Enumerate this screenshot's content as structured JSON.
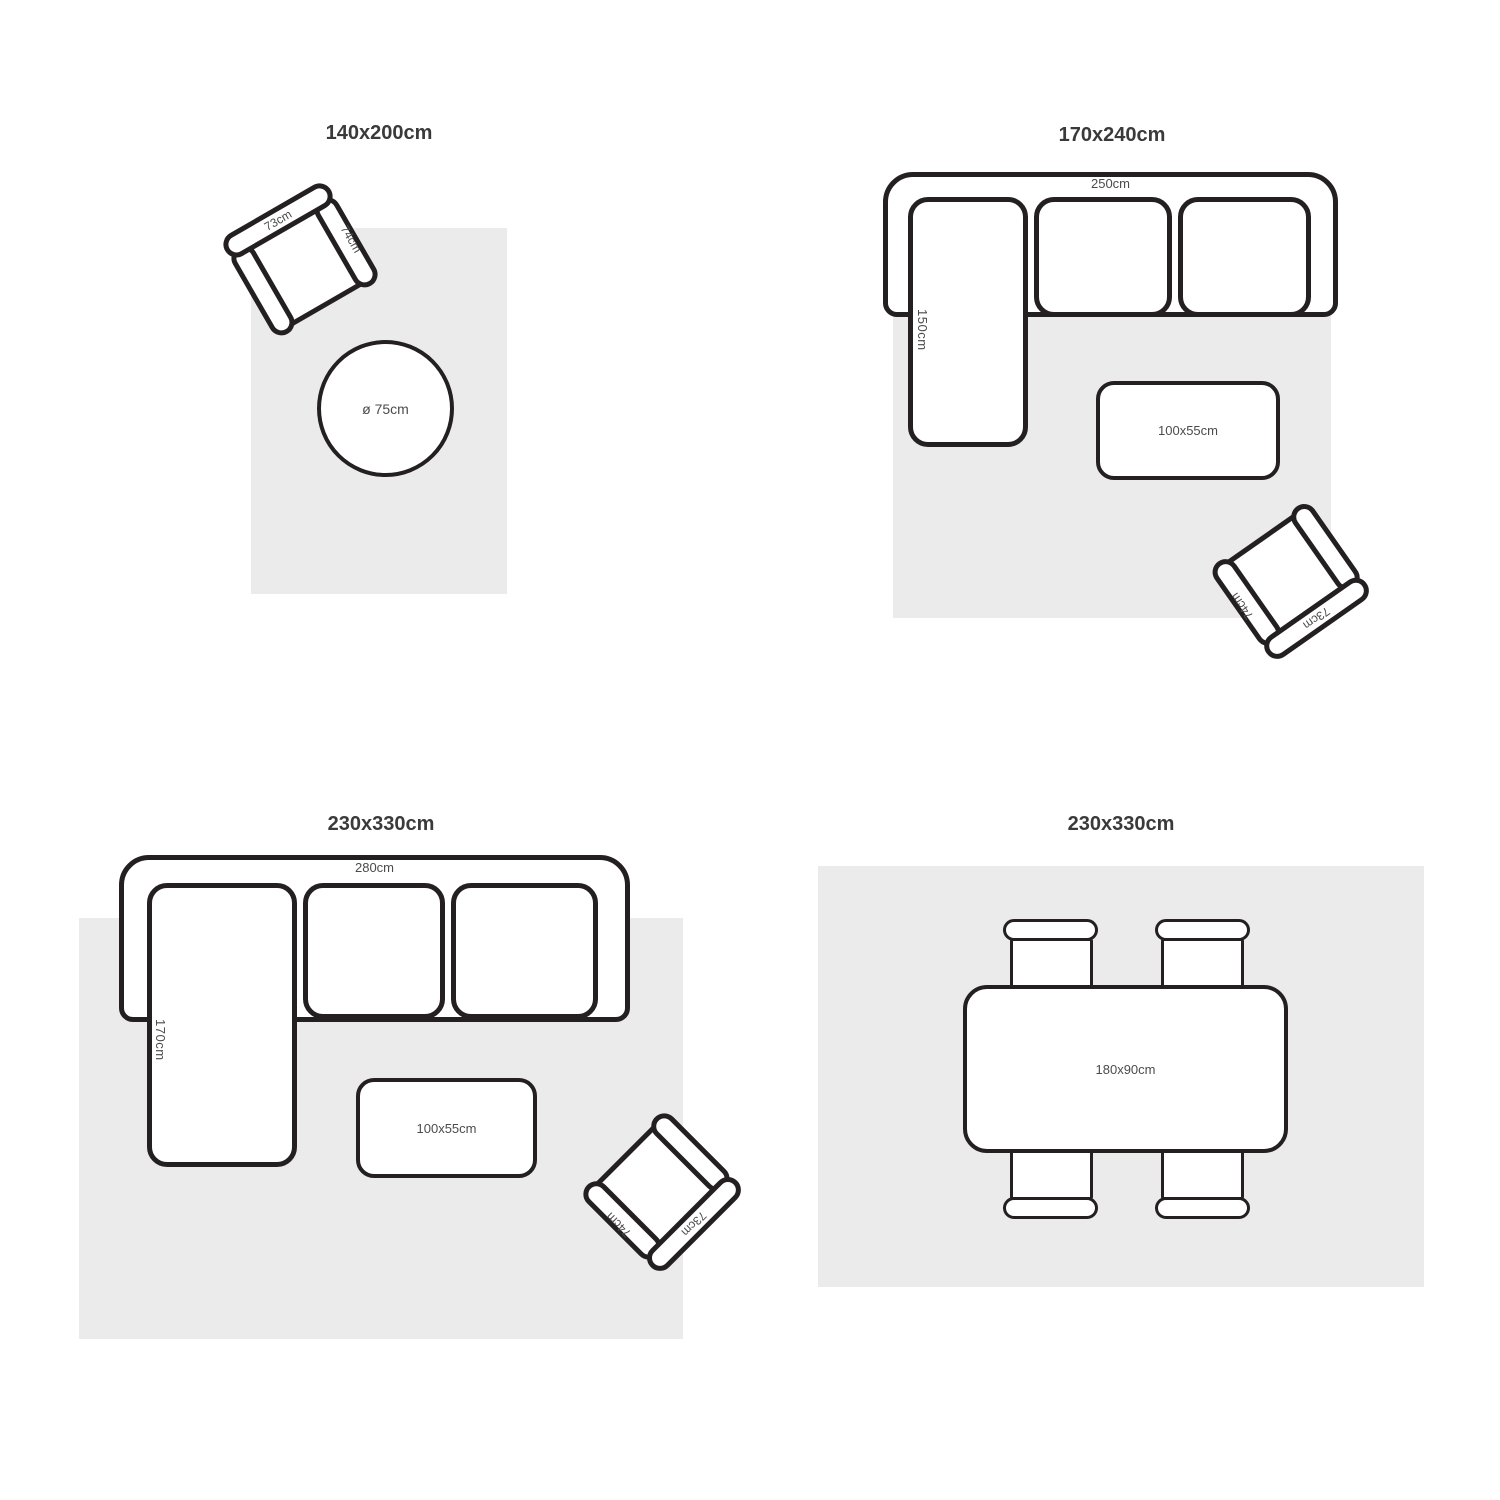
{
  "colors": {
    "rug": "#ebebeb",
    "outline": "#242021",
    "title_text": "#3a3a3a",
    "label_text": "#4b4b4b"
  },
  "panels": [
    {
      "id": "rug-140x200",
      "title": "140x200cm",
      "armchair": {
        "back_label": "73cm",
        "arm_label": "74cm"
      },
      "round_table": {
        "label": "ø 75cm"
      }
    },
    {
      "id": "rug-170x240",
      "title": "170x240cm",
      "sofa": {
        "width_label": "250cm",
        "chaise_label": "150cm"
      },
      "coffee_table": {
        "label": "100x55cm"
      },
      "armchair": {
        "back_label": "73cm",
        "arm_label": "74cm"
      }
    },
    {
      "id": "rug-230x330-sofa",
      "title": "230x330cm",
      "sofa": {
        "width_label": "280cm",
        "chaise_label": "170cm"
      },
      "coffee_table": {
        "label": "100x55cm"
      },
      "armchair": {
        "back_label": "73cm",
        "arm_label": "74cm"
      }
    },
    {
      "id": "rug-230x330-dining",
      "title": "230x330cm",
      "dining_table": {
        "label": "180x90cm"
      }
    }
  ]
}
